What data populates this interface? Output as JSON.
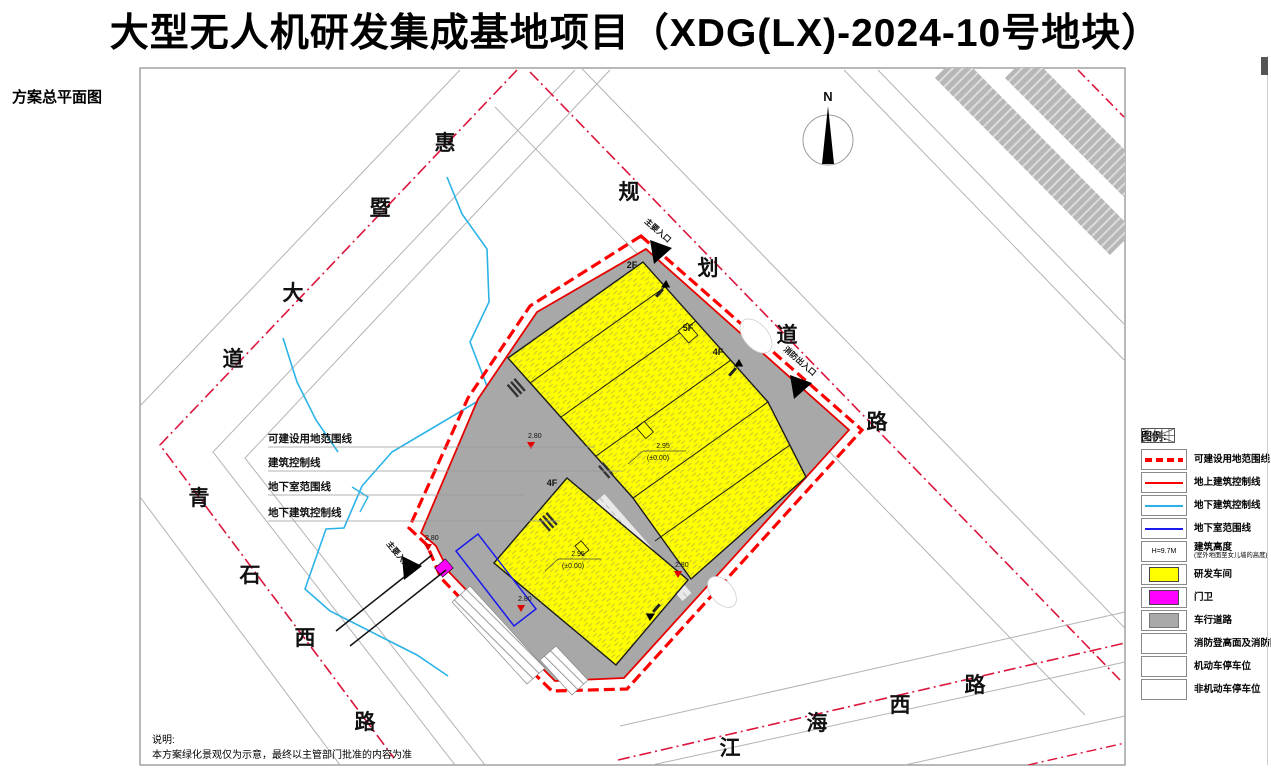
{
  "title": "大型无人机研发集成基地项目（XDG(LX)-2024-10号地块）",
  "plan_label": "方案总平面图",
  "compass": {
    "north": "N"
  },
  "roads": {
    "huiji": [
      "惠",
      "暨",
      "大",
      "道"
    ],
    "guihua": [
      "规",
      "划",
      "道",
      "路"
    ],
    "qingshi": [
      "青",
      "石",
      "西",
      "路"
    ],
    "jianghai": [
      "江",
      "海",
      "西",
      "路"
    ]
  },
  "callouts": [
    "可建设用地范围线",
    "建筑控制线",
    "地下室范围线",
    "地下建筑控制线"
  ],
  "entrances": {
    "main_top": "主要入口",
    "fire_side": "消防出入口",
    "main_west": "主要入口"
  },
  "floors": {
    "f2": "2F",
    "f5": "5F",
    "f4a": "4F",
    "f4b": "4F"
  },
  "levels": {
    "ffl": "2.95",
    "ffl_note": "(±0.00)",
    "marker": "2.80"
  },
  "legend": {
    "title": "图例:",
    "items": [
      {
        "label": "可建设用地范围线"
      },
      {
        "label": "地上建筑控制线"
      },
      {
        "label": "地下建筑控制线"
      },
      {
        "label": "地下室范围线"
      },
      {
        "label": "建筑高度",
        "sublabel": "(室外地面至女儿墙的高度)",
        "symbol": "H=9.7M"
      },
      {
        "label": "研发车间"
      },
      {
        "label": "门卫"
      },
      {
        "label": "车行道路"
      },
      {
        "label": "消防登高面及消防回车场"
      },
      {
        "label": "机动车停车位"
      },
      {
        "label": "非机动车停车位"
      }
    ]
  },
  "note": {
    "heading": "说明:",
    "body": "本方案绿化景观仅为示意，最终以主管部门批准的内容为准"
  },
  "colors": {
    "boundary_red": "#ff0000",
    "road_centerline": "#dc143c",
    "underground_cyan": "#2bb3e8",
    "basement_blue": "#1a1aee",
    "workshop_yellow": "#ffff00",
    "gatehouse_magenta": "#ff00ff",
    "road_gray": "#a9a9a9"
  }
}
